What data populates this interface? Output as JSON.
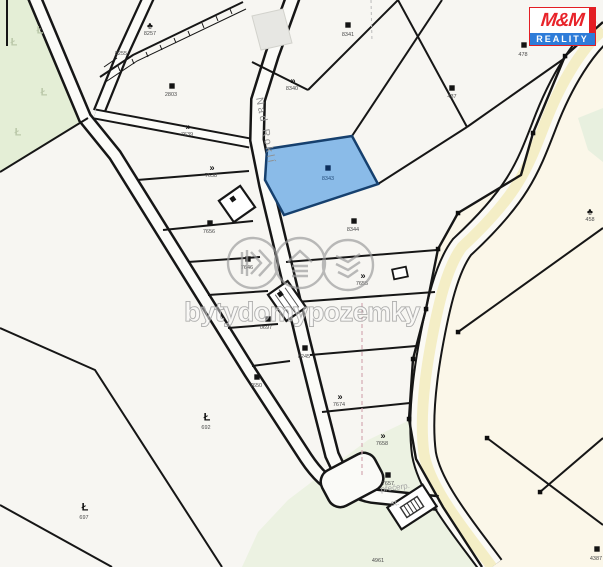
{
  "logo": {
    "title": "M&M",
    "subtitle": "REALITY",
    "accent_red": "#e31e24",
    "accent_blue": "#2e7cd9"
  },
  "watermark": {
    "text": "bytydomypozemky"
  },
  "street": {
    "name": "Nad Roklí"
  },
  "area_note": {
    "line1": "přečerp.",
    "line2": "st."
  },
  "colors": {
    "selected_parcel_fill": "#8abbe8",
    "selected_parcel_border": "#16406e",
    "forest_fill": "#e4eed6",
    "meadow_fill": "#ecf2e2",
    "cream_fill": "#fbf7e9",
    "road_yellow": "#f4eec6",
    "line_black": "#161616"
  },
  "selected_parcel": {
    "number": "8343"
  },
  "parcels": [
    {
      "label": "8257",
      "x": 150,
      "y": 35,
      "glyph": "tree",
      "gx": 150,
      "gy": 25
    },
    {
      "label": "8255",
      "x": 121,
      "y": 55,
      "glyph": "none",
      "gx": 0,
      "gy": 0
    },
    {
      "label": "2803",
      "x": 171,
      "y": 96,
      "glyph": "sq",
      "gx": 172,
      "gy": 86
    },
    {
      "label": "7639",
      "x": 187,
      "y": 136,
      "glyph": "arr",
      "gx": 188,
      "gy": 126
    },
    {
      "label": "7638",
      "x": 211,
      "y": 177,
      "glyph": "arr",
      "gx": 212,
      "gy": 167
    },
    {
      "label": "8340",
      "x": 292,
      "y": 90,
      "glyph": "arr",
      "gx": 293,
      "gy": 80
    },
    {
      "label": "8341",
      "x": 348,
      "y": 36,
      "glyph": "sq",
      "gx": 348,
      "gy": 25
    },
    {
      "label": "437",
      "x": 452,
      "y": 98,
      "glyph": "sq",
      "gx": 452,
      "gy": 88
    },
    {
      "label": "478",
      "x": 523,
      "y": 56,
      "glyph": "sq",
      "gx": 524,
      "gy": 45
    },
    {
      "label": "458",
      "x": 590,
      "y": 221,
      "glyph": "tree",
      "gx": 590,
      "gy": 211
    },
    {
      "label": "8344",
      "x": 353,
      "y": 231,
      "glyph": "sq",
      "gx": 354,
      "gy": 221
    },
    {
      "label": "7655",
      "x": 362,
      "y": 285,
      "glyph": "arr",
      "gx": 363,
      "gy": 275
    },
    {
      "label": "7656",
      "x": 209,
      "y": 233,
      "glyph": "sq",
      "gx": 210,
      "gy": 223
    },
    {
      "label": "7646",
      "x": 247,
      "y": 269,
      "glyph": "sq",
      "gx": 248,
      "gy": 259
    },
    {
      "label": "0697",
      "x": 266,
      "y": 329,
      "glyph": "sq",
      "gx": 268,
      "gy": 319
    },
    {
      "label": "8245",
      "x": 304,
      "y": 358,
      "glyph": "sq",
      "gx": 305,
      "gy": 348
    },
    {
      "label": "7674",
      "x": 339,
      "y": 406,
      "glyph": "arr",
      "gx": 340,
      "gy": 396
    },
    {
      "label": "7658",
      "x": 382,
      "y": 445,
      "glyph": "arr",
      "gx": 383,
      "gy": 435
    },
    {
      "label": "7657",
      "x": 388,
      "y": 485,
      "glyph": "sq",
      "gx": 388,
      "gy": 475
    },
    {
      "label": "7650",
      "x": 256,
      "y": 387,
      "glyph": "sq",
      "gx": 257,
      "gy": 377
    },
    {
      "label": "692",
      "x": 206,
      "y": 429,
      "glyph": "L",
      "gx": 207,
      "gy": 417
    },
    {
      "label": "697",
      "x": 84,
      "y": 519,
      "glyph": "L",
      "gx": 85,
      "gy": 507
    },
    {
      "label": "4387",
      "x": 596,
      "y": 560,
      "glyph": "sq",
      "gx": 597,
      "gy": 549
    },
    {
      "label": "4961",
      "x": 378,
      "y": 562,
      "glyph": "none",
      "gx": 0,
      "gy": 0
    },
    {
      "label": "8343",
      "x": 328,
      "y": 180,
      "glyph": "sq",
      "gx": 328,
      "gy": 168,
      "selected": true
    },
    {
      "label": "",
      "x": 0,
      "y": 0,
      "glyph": "L",
      "gx": 14,
      "gy": 42,
      "faint": true
    },
    {
      "label": "",
      "x": 0,
      "y": 0,
      "glyph": "L",
      "gx": 44,
      "gy": 92,
      "faint": true
    },
    {
      "label": "",
      "x": 0,
      "y": 0,
      "glyph": "L",
      "gx": 18,
      "gy": 132,
      "faint": true
    },
    {
      "label": "",
      "x": 0,
      "y": 0,
      "glyph": "L",
      "gx": 40,
      "gy": 30,
      "faint": true
    }
  ]
}
